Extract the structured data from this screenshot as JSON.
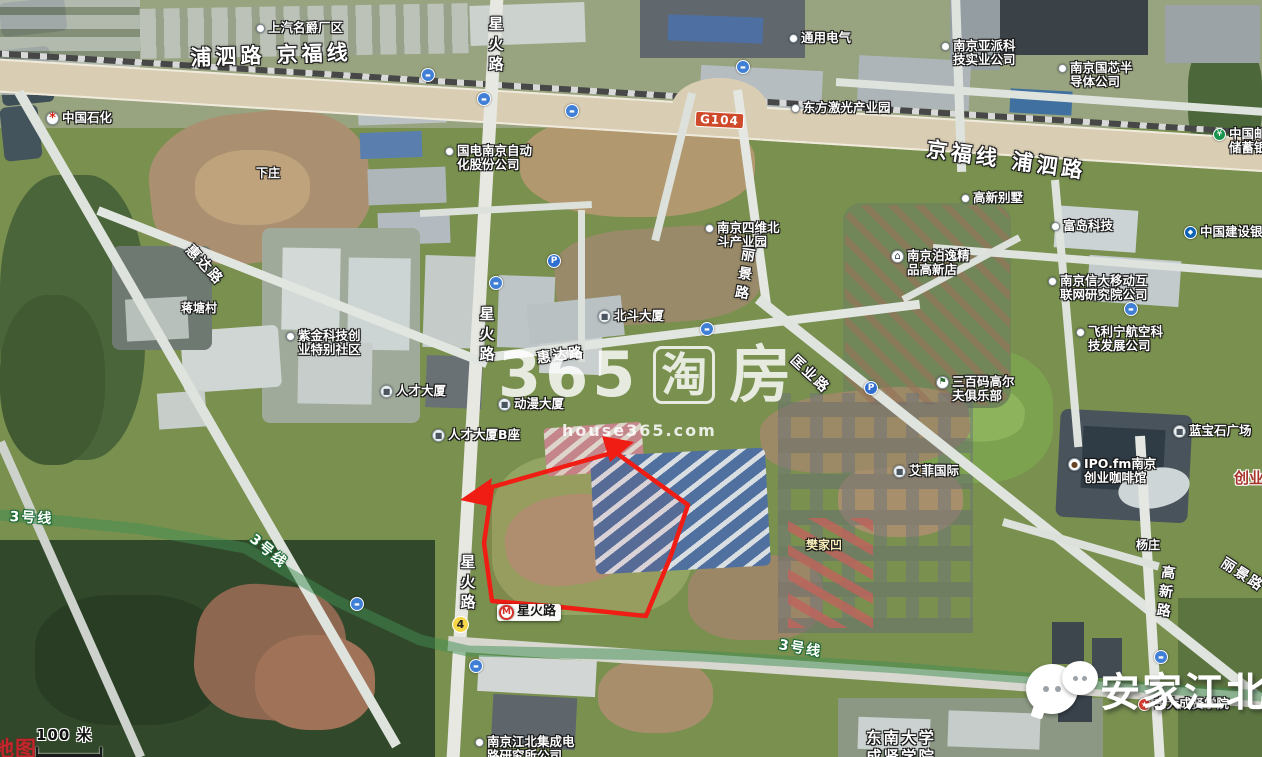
{
  "map": {
    "watermark": {
      "brand_number": "365",
      "brand_tao": "淘",
      "brand_fang": "房",
      "site": "house365.com"
    },
    "corner_watermark": {
      "text": "安家江北"
    },
    "scale": {
      "label": "100 米"
    },
    "corner_partial_text": "地图",
    "highlight_color": "#f01d14",
    "metro_line_color": "#3f8d52",
    "badges": [
      {
        "id": "g104",
        "text": "G104",
        "x": 695,
        "y": 112
      },
      {
        "id": "route4",
        "text": "4",
        "x": 452,
        "y": 616
      }
    ],
    "road_labels": [
      {
        "text": "浦泗路 京福线",
        "x": 190,
        "y": 47,
        "size": 21,
        "rot": -2,
        "big": true
      },
      {
        "text": "京福线 浦泗路",
        "x": 928,
        "y": 138,
        "size": 21,
        "rot": 8,
        "big": true
      },
      {
        "text": "星火路",
        "x": 487,
        "y": 16,
        "size": 15,
        "v": true
      },
      {
        "text": "星火路",
        "x": 478,
        "y": 306,
        "size": 15,
        "v": true
      },
      {
        "text": "星火路",
        "x": 459,
        "y": 554,
        "size": 15,
        "v": true
      },
      {
        "text": "惠达路",
        "x": 193,
        "y": 243,
        "size": 14,
        "rot": 47
      },
      {
        "text": "惠达路",
        "x": 536,
        "y": 352,
        "size": 14,
        "rot": -8
      },
      {
        "text": "丽景路",
        "x": 740,
        "y": 246,
        "size": 14,
        "v": true,
        "rot": 9
      },
      {
        "text": "匡业路",
        "x": 797,
        "y": 353,
        "size": 14,
        "rot": 43
      },
      {
        "text": "高新路",
        "x": 1160,
        "y": 564,
        "size": 14,
        "v": true,
        "rot": 7
      },
      {
        "text": "丽景路",
        "x": 1226,
        "y": 556,
        "size": 14,
        "rot": 33
      },
      {
        "text": "3号线",
        "x": 10,
        "y": 510,
        "size": 14,
        "rot": 3,
        "metro": true
      },
      {
        "text": "3号线",
        "x": 256,
        "y": 532,
        "size": 14,
        "rot": 40,
        "metro": true
      },
      {
        "text": "3号线",
        "x": 780,
        "y": 638,
        "size": 14,
        "rot": 10,
        "metro": true
      },
      {
        "text": "3号线",
        "x": 1046,
        "y": 674,
        "size": 13,
        "rot": 13,
        "metro": true
      }
    ],
    "poi_labels": [
      {
        "id": "saic-mg-plant",
        "icon": "dot",
        "lines": [
          "上汽名爵厂区"
        ],
        "x": 256,
        "y": 21
      },
      {
        "id": "sinopec",
        "icon": "sinopec",
        "lines": [
          "中国石化"
        ],
        "x": 46,
        "y": 111
      },
      {
        "id": "general-electric",
        "icon": "dot",
        "lines": [
          "通用电气"
        ],
        "x": 789,
        "y": 31
      },
      {
        "id": "dongfang-laser-park",
        "icon": "dot",
        "lines": [
          "东方激光产业园"
        ],
        "x": 791,
        "y": 101
      },
      {
        "id": "yapai-tech",
        "icon": "dot",
        "lines": [
          "南京亚派科",
          "技实业公司"
        ],
        "x": 941,
        "y": 39
      },
      {
        "id": "guoxin-semiconductor",
        "icon": "dot",
        "lines": [
          "南京国芯半",
          "导体公司"
        ],
        "x": 1058,
        "y": 61
      },
      {
        "id": "psbc-bank",
        "icon": "bank-green",
        "lines": [
          "中国邮政",
          "储蓄银行"
        ],
        "x": 1213,
        "y": 127
      },
      {
        "id": "guodian-nanjing-automation",
        "icon": "dot",
        "lines": [
          "国电南京自动",
          "化股份公司"
        ],
        "x": 445,
        "y": 144
      },
      {
        "id": "siwei-beidou-park",
        "icon": "dot",
        "lines": [
          "南京四维北",
          "斗产业园"
        ],
        "x": 705,
        "y": 221
      },
      {
        "id": "gaoxin-villa",
        "icon": "dot",
        "lines": [
          "高新别墅"
        ],
        "x": 961,
        "y": 191
      },
      {
        "id": "fudao-tech",
        "icon": "dot",
        "lines": [
          "富岛科技"
        ],
        "x": 1051,
        "y": 219
      },
      {
        "id": "boyi-hotel",
        "icon": "hotel",
        "lines": [
          "南京泊逸精",
          "品高新店"
        ],
        "x": 891,
        "y": 249
      },
      {
        "id": "xinda-mobile-institute",
        "icon": "dot",
        "lines": [
          "南京信大移动互",
          "联网研究院公司"
        ],
        "x": 1048,
        "y": 274
      },
      {
        "id": "ccb-bank",
        "icon": "bank-ccb",
        "lines": [
          "中国建设银行"
        ],
        "x": 1184,
        "y": 225
      },
      {
        "id": "feilining-aviation",
        "icon": "dot",
        "lines": [
          "飞利宁航空科",
          "技发展公司"
        ],
        "x": 1076,
        "y": 325
      },
      {
        "id": "300yard-golf-club",
        "icon": "golf",
        "lines": [
          "三百码高尔",
          "夫俱乐部"
        ],
        "x": 936,
        "y": 375
      },
      {
        "id": "sapphire-plaza",
        "icon": "building",
        "lines": [
          "蓝宝石广场"
        ],
        "x": 1173,
        "y": 424
      },
      {
        "id": "ipo-fm-cafe",
        "icon": "coffee",
        "lines": [
          "IPO.fm南京",
          "创业咖啡馆"
        ],
        "x": 1068,
        "y": 457
      },
      {
        "id": "beidou-tower",
        "icon": "building",
        "lines": [
          "北斗大厦"
        ],
        "x": 598,
        "y": 309
      },
      {
        "id": "rencai-tower",
        "icon": "building",
        "lines": [
          "人才大厦"
        ],
        "x": 380,
        "y": 384
      },
      {
        "id": "dongman-tower",
        "icon": "building",
        "lines": [
          "动漫大厦"
        ],
        "x": 498,
        "y": 397
      },
      {
        "id": "rencai-tower-b",
        "icon": "building",
        "lines": [
          "人才大厦B座"
        ],
        "x": 432,
        "y": 428
      },
      {
        "id": "zijin-tech-community",
        "icon": "dot",
        "lines": [
          "紫金科技创",
          "业特别社区"
        ],
        "x": 286,
        "y": 329
      },
      {
        "id": "aifei-international",
        "icon": "building",
        "lines": [
          "艾菲国际"
        ],
        "x": 893,
        "y": 464
      },
      {
        "id": "jiangbei-ic-institute",
        "icon": "dot",
        "lines": [
          "南京江北集成电",
          "路研究所公司"
        ],
        "x": 475,
        "y": 735
      },
      {
        "id": "dongda-chengxian-college",
        "icon": "school",
        "lines": [
          "东大成贤学院"
        ],
        "x": 1138,
        "y": 697
      },
      {
        "id": "xinghuolu-metro-station",
        "icon": "metro",
        "lines": [
          "星火路"
        ],
        "x": 497,
        "y": 604,
        "cls": "station"
      },
      {
        "id": "seu-chengxian-college",
        "lines": [
          "东南大学",
          "成贤学院"
        ],
        "x": 866,
        "y": 729,
        "cls": "campus"
      },
      {
        "id": "xiazhuang-village",
        "lines": [
          "下庄"
        ],
        "x": 256,
        "y": 167,
        "cls": "village"
      },
      {
        "id": "jiangtang-village",
        "lines": [
          "蒋塘村"
        ],
        "x": 181,
        "y": 302,
        "cls": "village"
      },
      {
        "id": "fanjiaao-village",
        "lines": [
          "樊家凹"
        ],
        "x": 806,
        "y": 539,
        "cls": "village village-y"
      },
      {
        "id": "yangzhuang-village",
        "lines": [
          "杨庄"
        ],
        "x": 1136,
        "y": 539,
        "cls": "village"
      },
      {
        "id": "chuangye-clipped",
        "lines": [
          "创业"
        ],
        "x": 1234,
        "y": 470,
        "cls": "red-label"
      }
    ],
    "transit_icons": [
      {
        "type": "bus",
        "x": 421,
        "y": 68
      },
      {
        "type": "bus",
        "x": 477,
        "y": 92
      },
      {
        "type": "bus",
        "x": 565,
        "y": 104
      },
      {
        "type": "bus",
        "x": 736,
        "y": 60
      },
      {
        "type": "bus",
        "x": 489,
        "y": 276
      },
      {
        "type": "bus",
        "x": 700,
        "y": 322
      },
      {
        "type": "bus",
        "x": 1124,
        "y": 302
      },
      {
        "type": "bus",
        "x": 350,
        "y": 597
      },
      {
        "type": "bus",
        "x": 469,
        "y": 659
      },
      {
        "type": "bus",
        "x": 1154,
        "y": 650
      },
      {
        "type": "parking",
        "x": 547,
        "y": 254
      },
      {
        "type": "parking",
        "x": 864,
        "y": 381
      }
    ]
  }
}
